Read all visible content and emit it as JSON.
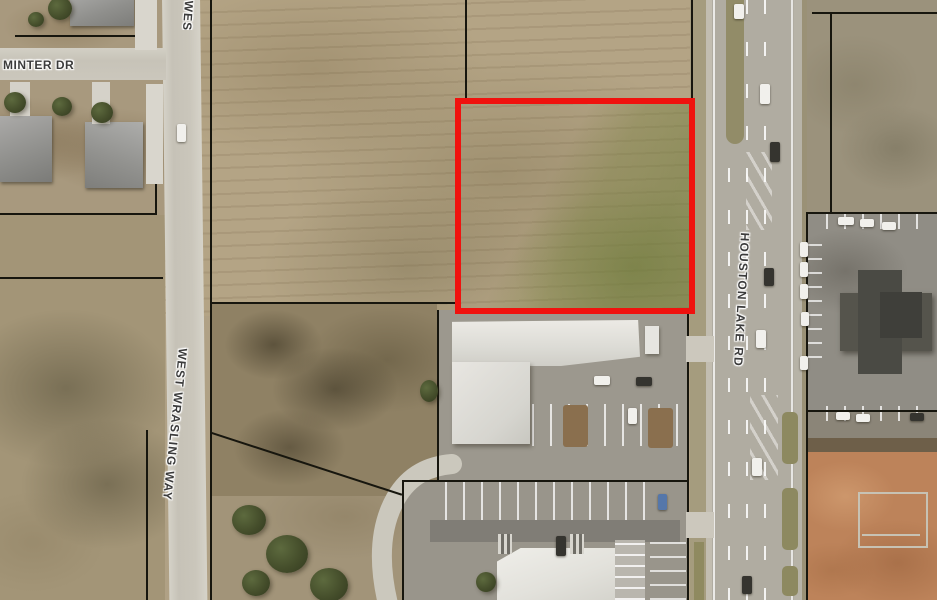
{
  "map": {
    "type": "aerial-parcel-map",
    "road_labels": {
      "minter_dr": "MINTER DR",
      "west_wrasling_way": "WEST WRASLING WAY",
      "west_wrasling_way_clipped": "WEST WRASLING WAY",
      "houston_lake_rd": "HOUSTON LAKE RD"
    },
    "highlight_parcel": {
      "outline_color": "#f0120e"
    },
    "palette": {
      "parcel_line": "#17160e",
      "field_tan": "#b4a485",
      "field_green": "#8d9163",
      "highway_asphalt": "#b0aca1",
      "residential_road": "#c9c5ba",
      "white_roof": "#e4e3de",
      "dark_roof": "#4e4e48",
      "graded_dirt": "#bd835a",
      "label_text": "#3b3b3b",
      "label_halo": "#ffffff"
    }
  }
}
